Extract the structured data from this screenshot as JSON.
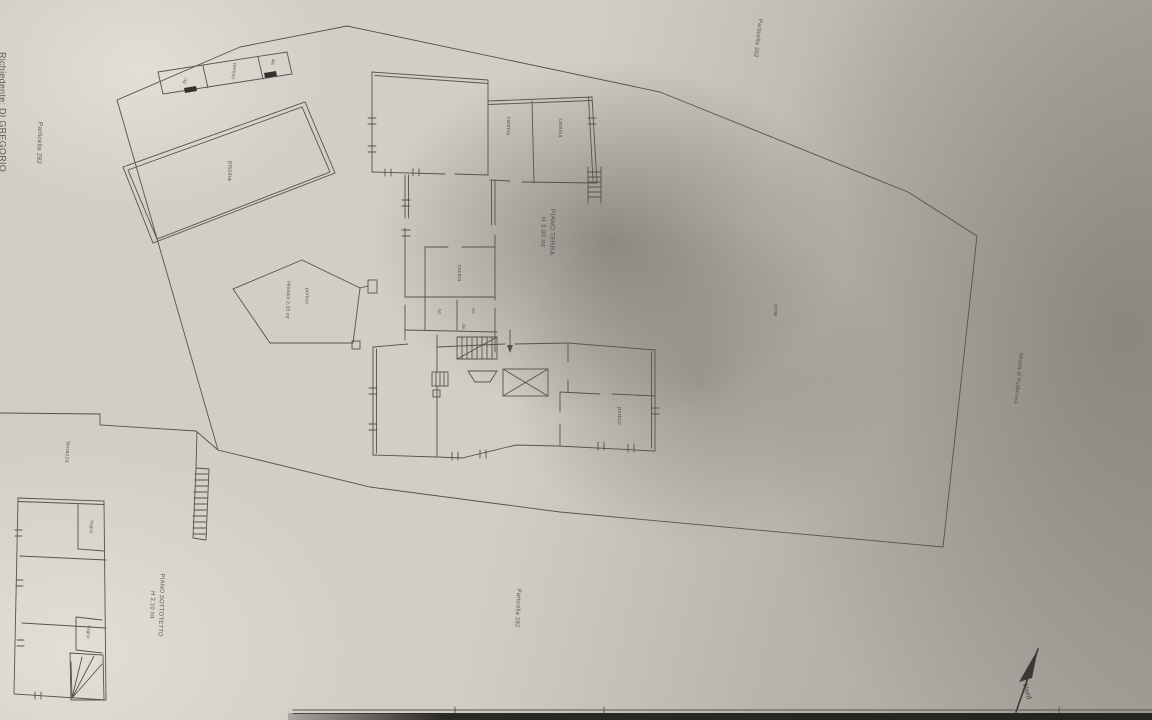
{
  "colors": {
    "paper": "#d2cec7",
    "shadow": "#8e8b84",
    "ink": "#4b4944",
    "line": "#55534c",
    "dark_edge": "#2b2925"
  },
  "labels": {
    "richiedente": "Richiedente: DI GREGORIO",
    "particella_left": "Particella 282",
    "particella_top_right": "Particella 262",
    "particella_bottom": "Particella 282",
    "street": "Strada di Pudbrovia",
    "corte": "corte",
    "north": "Nord"
  },
  "pool": {
    "label": "piscina"
  },
  "outbuilding": {
    "rip": "rip",
    "portico": "portico",
    "wc": "wc"
  },
  "canopy": {
    "label": "portico",
    "height": "Hmedia 2.35 mt"
  },
  "main_house": {
    "floor_title": "PIANO TERRA",
    "floor_height": "H 3.00 mt",
    "cantina_1": "cantina",
    "cantina_2": "cantina",
    "cucina": "cucina",
    "rip": "rip.",
    "wc": "wc",
    "dis": "dis.",
    "portico": "portico"
  },
  "attic": {
    "floor_title": "PIANO SOTTOTETTO",
    "floor_height": "H 2.10 mt",
    "terrazza": "terrazza",
    "bagno_1": "bagno",
    "bagno_2": "bagno"
  }
}
